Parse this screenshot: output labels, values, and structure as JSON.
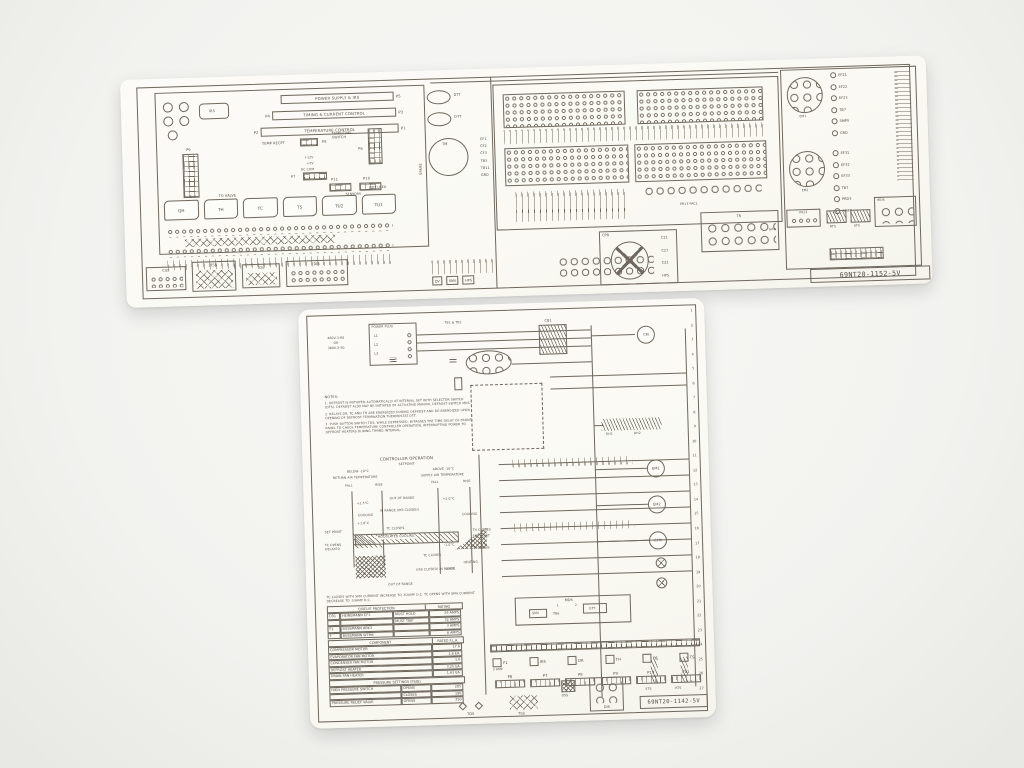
{
  "scene": {
    "bg": "#f2f2ef",
    "sheet": "#fbfaf5",
    "ink": "#534e46",
    "line": "#6e685e"
  },
  "top_sheet": {
    "part_number": "69NT20-1152-5V",
    "bars": [
      {
        "left": "",
        "label": "POWER SUPPLY & IRS",
        "right": "P5"
      },
      {
        "left": "P4",
        "label": "TIMING & CURRENT CONTROL",
        "right": "P3"
      },
      {
        "left": "P2",
        "label": "TEMPERATURE CONTROL",
        "right": "P1"
      }
    ],
    "labels": {
      "irs": "IRS",
      "p9": "P9",
      "temp_recpt": "TEMP RECPT",
      "p8": "P8",
      "temp_time": "TEMP/TIME SWITCH",
      "p6": "P6",
      "p7": "P7",
      "p10": "P10",
      "p11": "P11",
      "sensors": "SENSORS",
      "v12": "+12V",
      "v5": "+5V",
      "dc_com": "DC COM",
      "to_valve": "TO VALVE",
      "not_used": "NOT USED",
      "spare": "SPARE"
    },
    "components": [
      "QH",
      "TH",
      "TC",
      "TS",
      "TU2",
      "TU1"
    ],
    "bottom_boxes": [
      "CSS",
      "TSS",
      "TDS",
      "DIS"
    ],
    "mid": {
      "dtt1": "DTT",
      "dtt2": "DTT",
      "tm": "TM",
      "wires": [
        "CF1",
        "CF2",
        "CF3",
        "TB3",
        "TB11",
        "GRD"
      ],
      "valve_boxes": [
        "QV",
        "SMV",
        "HPS"
      ]
    },
    "cpr": {
      "label": "CPR",
      "wires": [
        "C21",
        "C23",
        "C22",
        "HPS"
      ]
    },
    "right": {
      "tr": "TR",
      "grd": "GRD",
      "pb13": "PB13 PAC1"
    },
    "far_right": {
      "em1": "EM1",
      "em2": "EM2",
      "em1_wires": [
        "EF21",
        "EF22",
        "EF23",
        "TB7",
        "SMP5",
        "GRD"
      ],
      "em2_wires": [
        "EF31",
        "EF32",
        "EF33",
        "TB7",
        "PRD3",
        "SMP5"
      ],
      "pa13": "PA13",
      "rts": "RTS",
      "sts": "STS",
      "wds": "WDS"
    }
  },
  "bottom_sheet": {
    "part_number": "69NT20-1142-5V",
    "power": {
      "plug": "POWER PLUG",
      "v1": "460V-3-60",
      "or": "OR",
      "v2": "380V-3-50",
      "tb": "TB1 & TB2",
      "cb1": "CB1",
      "lines": [
        "L1",
        "L2",
        "L3"
      ]
    },
    "notes": {
      "title": "NOTES:",
      "items": [
        "1. DEFROST IS INITIATED AUTOMATICALLY AT INTERVAL SET WITH SELECTOR SWITCH (DTS). DEFROST ALSO MAY BE INITIATED BY ACTUATING MANUAL DEFROST SWITCH MDS.",
        "2. RELAYS DR, TC AND TH ARE ENERGIZED DURING DEFROST AND DE-ENERGIZED UPON OPENING OF DEFROST TERMINATION THERMOSTAT DTT.",
        "3. PUSH BUTTON SWITCH TDS, WHILE DEPRESSED, BYPASSES THE TIME DELAY OF FRONT PANEL TO CHECK TEMPERATURE CONTROLLER OPERATION, INTERRUPTING POWER TO DEFROST HEATERS DURING TIMING INTERVAL."
      ]
    },
    "controller": {
      "title": "CONTROLLER OPERATION",
      "setpoint": "SETPOINT",
      "below": "BELOW -10°C",
      "above": "ABOVE -10°C",
      "return_air": "RETURN AIR TEMPERATURE",
      "supply_air": "SUPPLY AIR TEMPERATURE",
      "fall": "FALL",
      "rise": "RISE",
      "t_p25": "+2.5°C",
      "t_p10": "+1.0°C",
      "t_p20": "+2.0°C",
      "t_m10": "-1.0°C",
      "t_m20": "-2.0°C",
      "out_of_range_top": "OUT OF RANGE",
      "in_range": "IN RANGE (IRS CLOSED)",
      "cooling_l": "COOLING",
      "cooling_r": "COOLING",
      "modulated": "MODULATED COOLING",
      "tc_closes": "TC CLOSES",
      "tc_opens": "TC OPENS DELAYED",
      "set_point_l": "SET POINT",
      "set_point_r": "SET POINT",
      "th_closes": "TH CLOSES",
      "th_opens": "TH OPENS",
      "tc_closes2": "TC CLOSES",
      "heating": "HEATING",
      "in_range2": "(IRS CLOSED) IN RANGE",
      "out_of_range_bottom": "OUT OF RANGE",
      "footnote": "TC CLOSES WITH SMV CURRENT INCREASE TO .62AMP D.C. TC OPENS WITH SMV CURRENT DECREASE TO .53AMP D.C."
    },
    "tables": {
      "circuit": {
        "title": "CIRCUIT PROTECTION",
        "rating": "RATING",
        "rows": [
          [
            "CB1",
            "HEINEMANN CF3",
            "MUST HOLD",
            "29 AMPS"
          ],
          [
            "",
            "",
            "MUST TRIP",
            "32 AMPS"
          ],
          [
            "F1",
            "BUSSMANN ABK3",
            "",
            "3 AMPS"
          ],
          [
            "F",
            "BUSSMANN WTM6",
            "",
            "6 AMPS"
          ]
        ]
      },
      "component": {
        "title": "COMPONENT",
        "rating": "RATED F.L.A.",
        "rows": [
          [
            "COMPRESSOR MOTOR",
            "17.6"
          ],
          [
            "EVAPORATOR FAN MOTOR",
            "1.6 EA."
          ],
          [
            "CONDENSER FAN MOTOR",
            "1.6"
          ],
          [
            "DEFROST HEATER",
            "3.25 EA."
          ],
          [
            "DRAIN PAN HEATER",
            "1.63 EA."
          ]
        ]
      },
      "pressure": {
        "title": "PRESSURE SETTINGS (PSIG)",
        "rows": [
          [
            "HIGH PRESSURE SWITCH",
            "OPENS",
            "285"
          ],
          [
            "",
            "CLOSES",
            "190"
          ],
          [
            "PRESSURE RELIEF VALVE",
            "OPENS",
            "350"
          ]
        ]
      }
    },
    "ladder": {
      "rungs": [
        "1",
        "2",
        "3",
        "4",
        "5",
        "6",
        "7",
        "8",
        "9",
        "10",
        "11",
        "12",
        "13",
        "14",
        "15",
        "16",
        "17",
        "18",
        "19",
        "20",
        "21",
        "22",
        "23",
        "24",
        "25",
        "26",
        "27"
      ],
      "motors": [
        "CM",
        "EM1",
        "EM2",
        "CFM"
      ],
      "heaters": [
        "DH1",
        "DH2"
      ],
      "mds": "MDS",
      "mds_pos": [
        "1",
        "2"
      ],
      "smv": "SMV",
      "tb6": "TB6",
      "dtt": "DTT",
      "amp": "3 AMP",
      "relays": [
        "F1",
        "IRS",
        "DR",
        "TH",
        "TC",
        "TS"
      ],
      "connectors": [
        "P6",
        "P7",
        "P8",
        "P9",
        "P10",
        "P11"
      ],
      "sensors": {
        "tds": "TDS",
        "tss": "TSS",
        "dss": "DSS",
        "dis": "DIS",
        "sts": "STS",
        "rts": "RTS"
      }
    }
  }
}
